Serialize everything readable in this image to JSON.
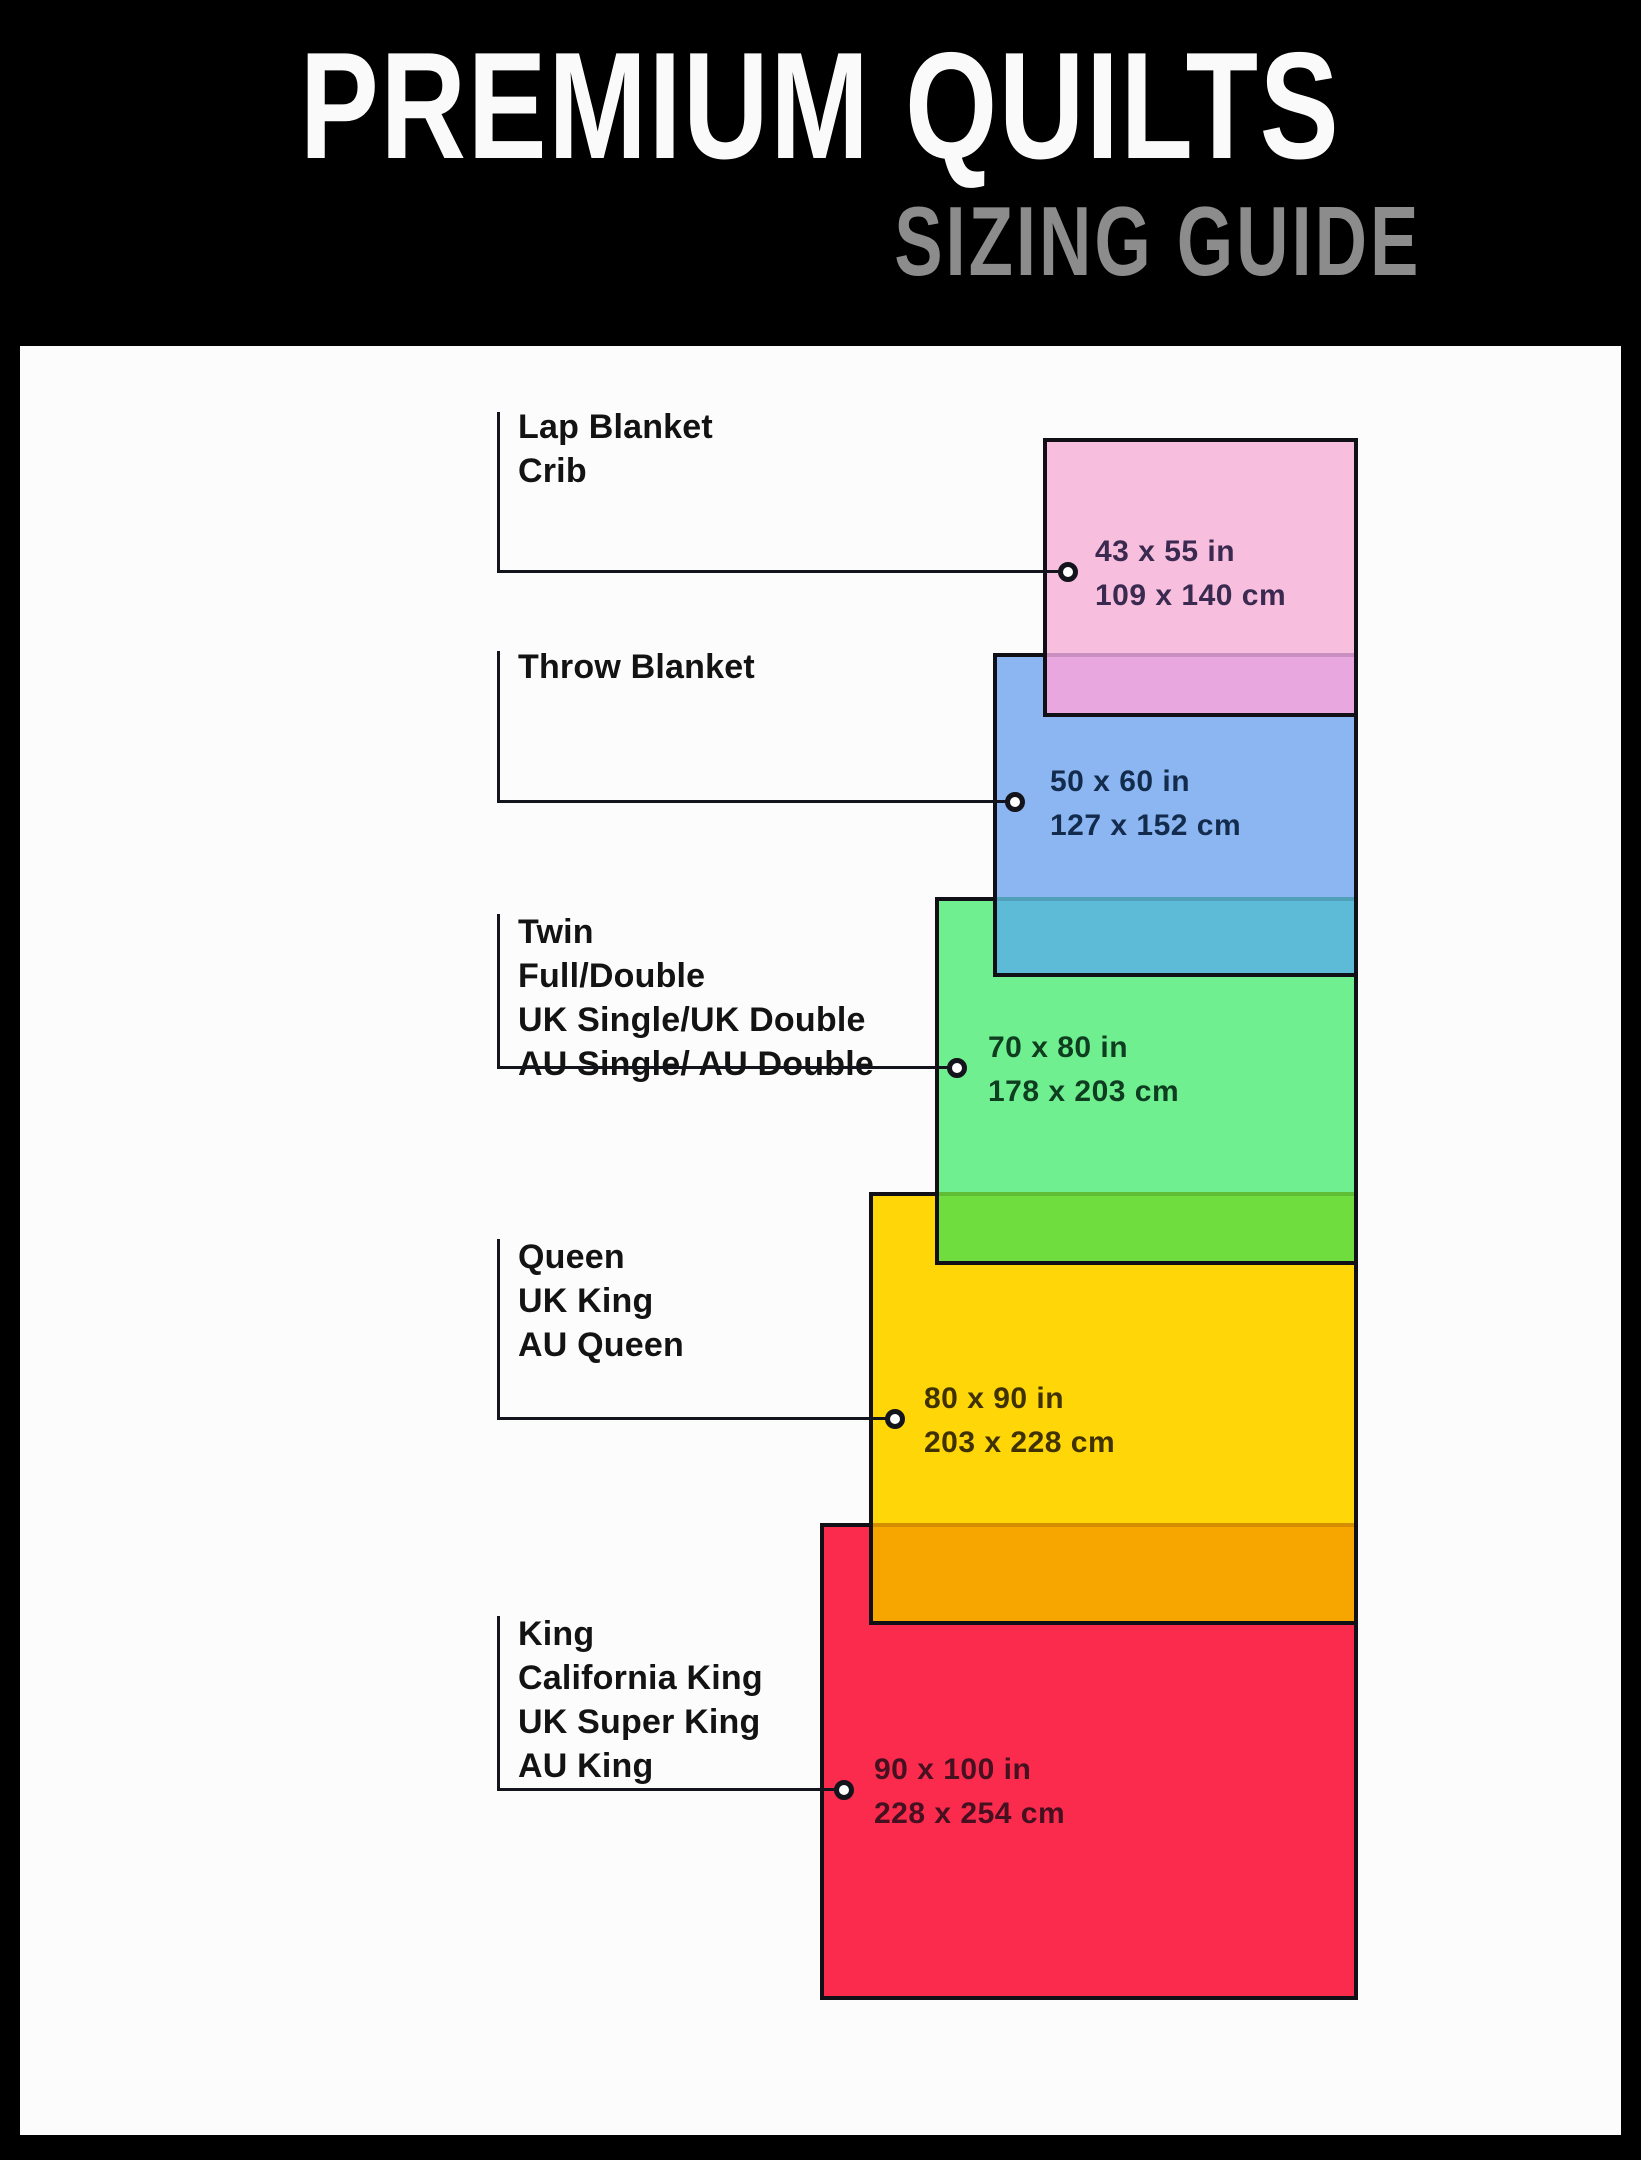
{
  "header": {
    "title": "PREMIUM QUILTS",
    "subtitle": "SIZING GUIDE"
  },
  "diagram": {
    "sizes": [
      {
        "key": "lap-blanket-crib",
        "labels": [
          "Lap Blanket",
          "Crib"
        ],
        "inches": "43 x 55 in",
        "cm": "109 x 140 cm",
        "fill": "#f8bedd",
        "ink": "#3b2a50"
      },
      {
        "key": "throw-blanket",
        "labels": [
          "Throw Blanket"
        ],
        "inches": "50 x 60 in",
        "cm": "127 x 152 cm",
        "fill": "#8cb6f1",
        "ink": "#132c4e"
      },
      {
        "key": "twin-full-double",
        "labels": [
          "Twin",
          "Full/Double",
          "UK Single/UK Double",
          "AU Single/ AU Double"
        ],
        "inches": "70 x 80 in",
        "cm": "178 x 203 cm",
        "fill": "#70ef90",
        "ink": "#0e3d20"
      },
      {
        "key": "queen",
        "labels": [
          "Queen",
          "UK King",
          "AU Queen"
        ],
        "inches": "80 x 90 in",
        "cm": "203 x 228 cm",
        "fill": "#ffd608",
        "ink": "#3f3200"
      },
      {
        "key": "king",
        "labels": [
          "King",
          "California King",
          "UK Super King",
          "AU King"
        ],
        "inches": "90 x 100 in",
        "cm": "228 x 254 cm",
        "fill": "#fb2b4d",
        "ink": "#45101f"
      }
    ],
    "overlaps": [
      {
        "between": "lap-blanket-crib/throw-blanket",
        "color": "#e9a7e0"
      },
      {
        "between": "throw-blanket/twin-full-double",
        "color": "#5dbbd7"
      },
      {
        "between": "twin-full-double/queen",
        "color": "#70dd3f"
      },
      {
        "between": "queen/king",
        "color": "#f7a600"
      }
    ],
    "colors": {
      "header_bg": "#000000",
      "title_ink": "#fafafa",
      "subtitle_ink": "#8c8c8c",
      "panel_bg": "#fcfcfc",
      "rect_border": "#101016",
      "label_ink": "#131313",
      "line": "#14141c",
      "dot_fill": "#ffffff"
    }
  }
}
